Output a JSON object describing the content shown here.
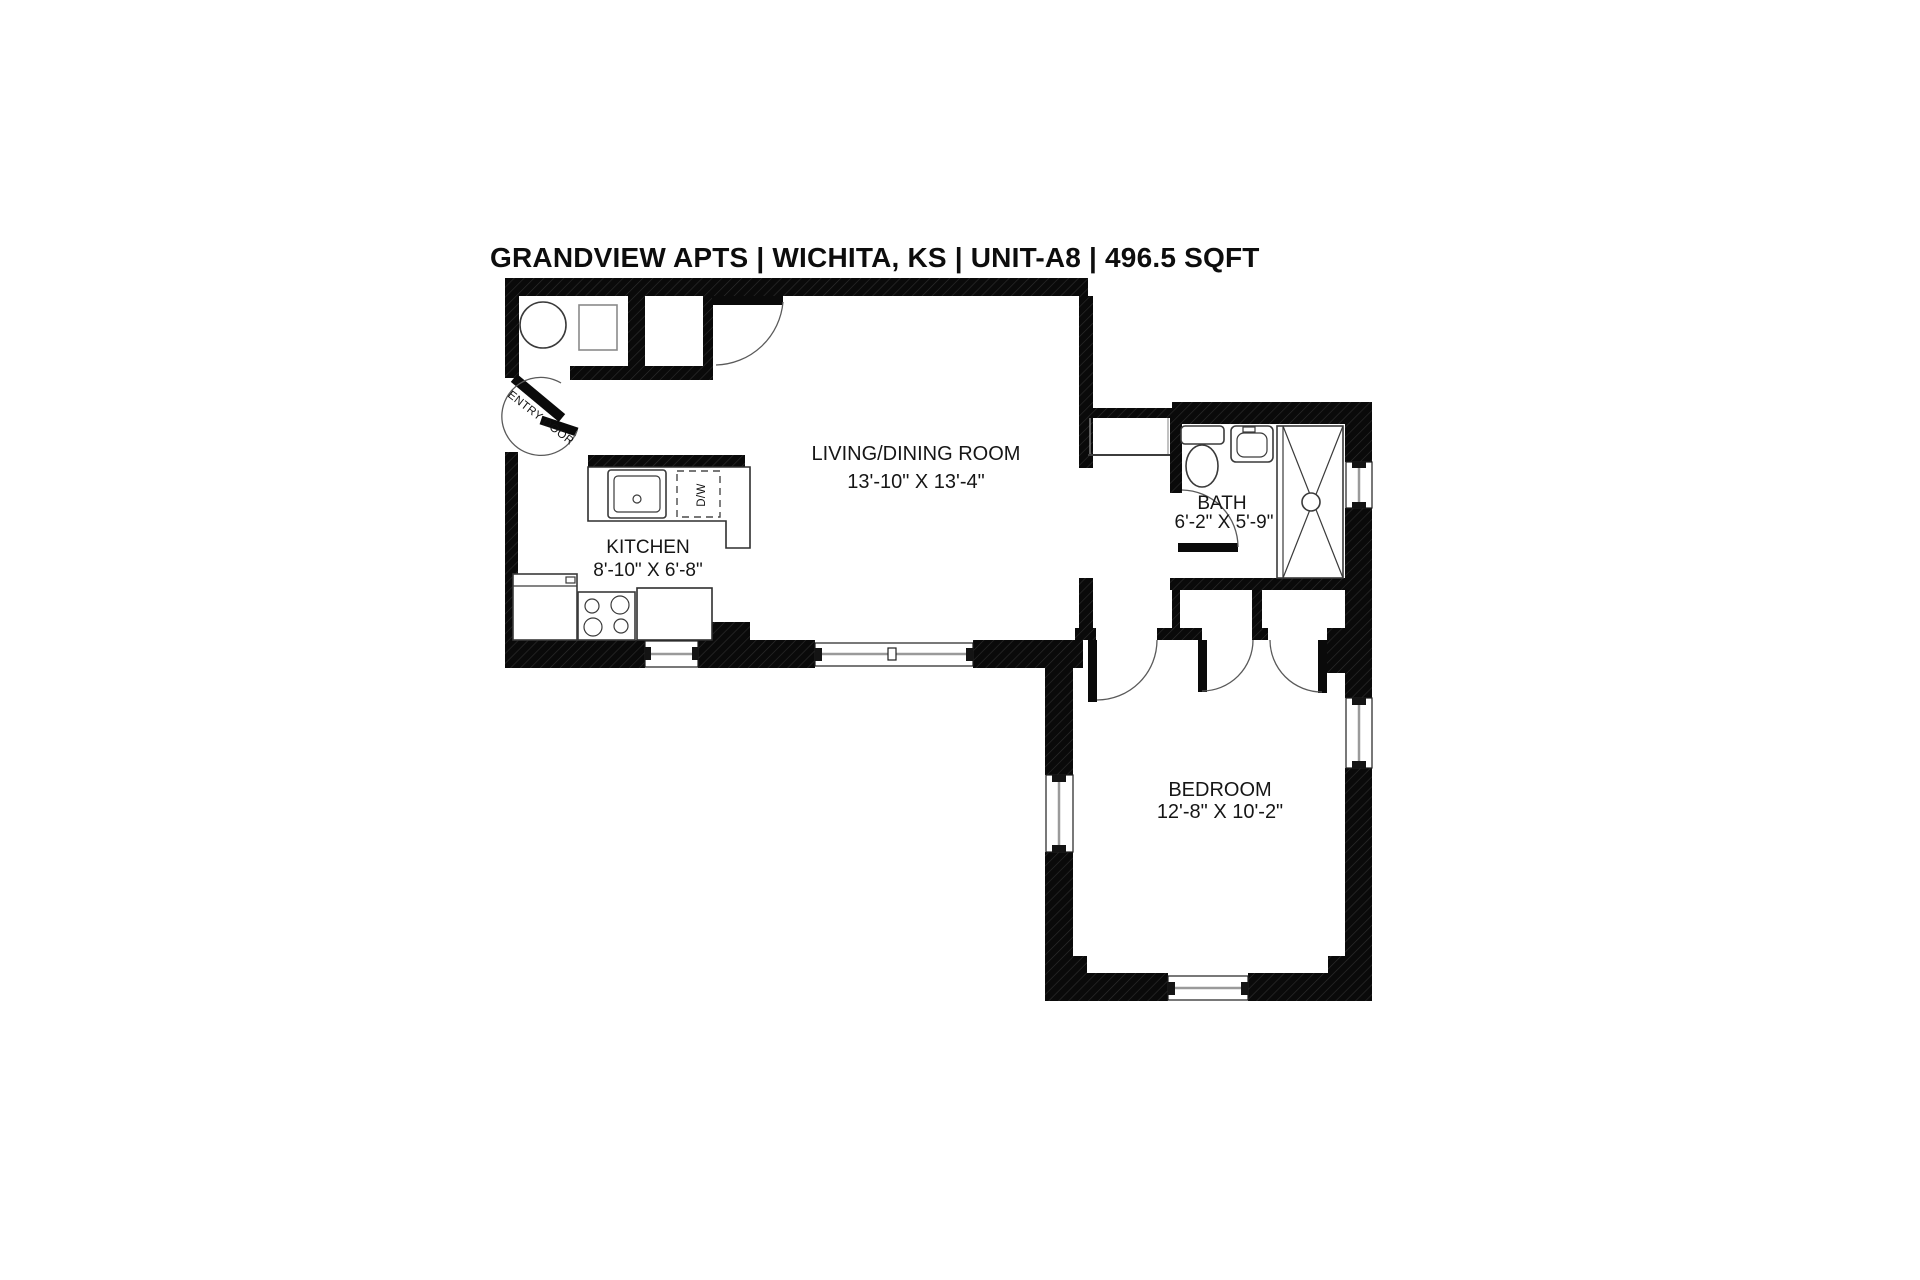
{
  "title": "GRANDVIEW APTS | WICHITA, KS | UNIT-A8 | 496.5 SQFT",
  "rooms": {
    "living_dining": {
      "name": "LIVING/DINING ROOM",
      "dimensions": "13'-10\" X 13'-4\""
    },
    "kitchen": {
      "name": "KITCHEN",
      "dimensions": "8'-10\" X 6'-8\""
    },
    "bath": {
      "name": "BATH",
      "dimensions": "6'-2\" X 5'-9\""
    },
    "bedroom": {
      "name": "BEDROOM",
      "dimensions": "12'-8\" X 10'-2\""
    }
  },
  "labels": {
    "entry_door": "ENTRY DOOR",
    "dishwasher": "D/W"
  },
  "colors": {
    "wall": "#0a0a0a",
    "background": "#ffffff",
    "text": "#161616"
  }
}
